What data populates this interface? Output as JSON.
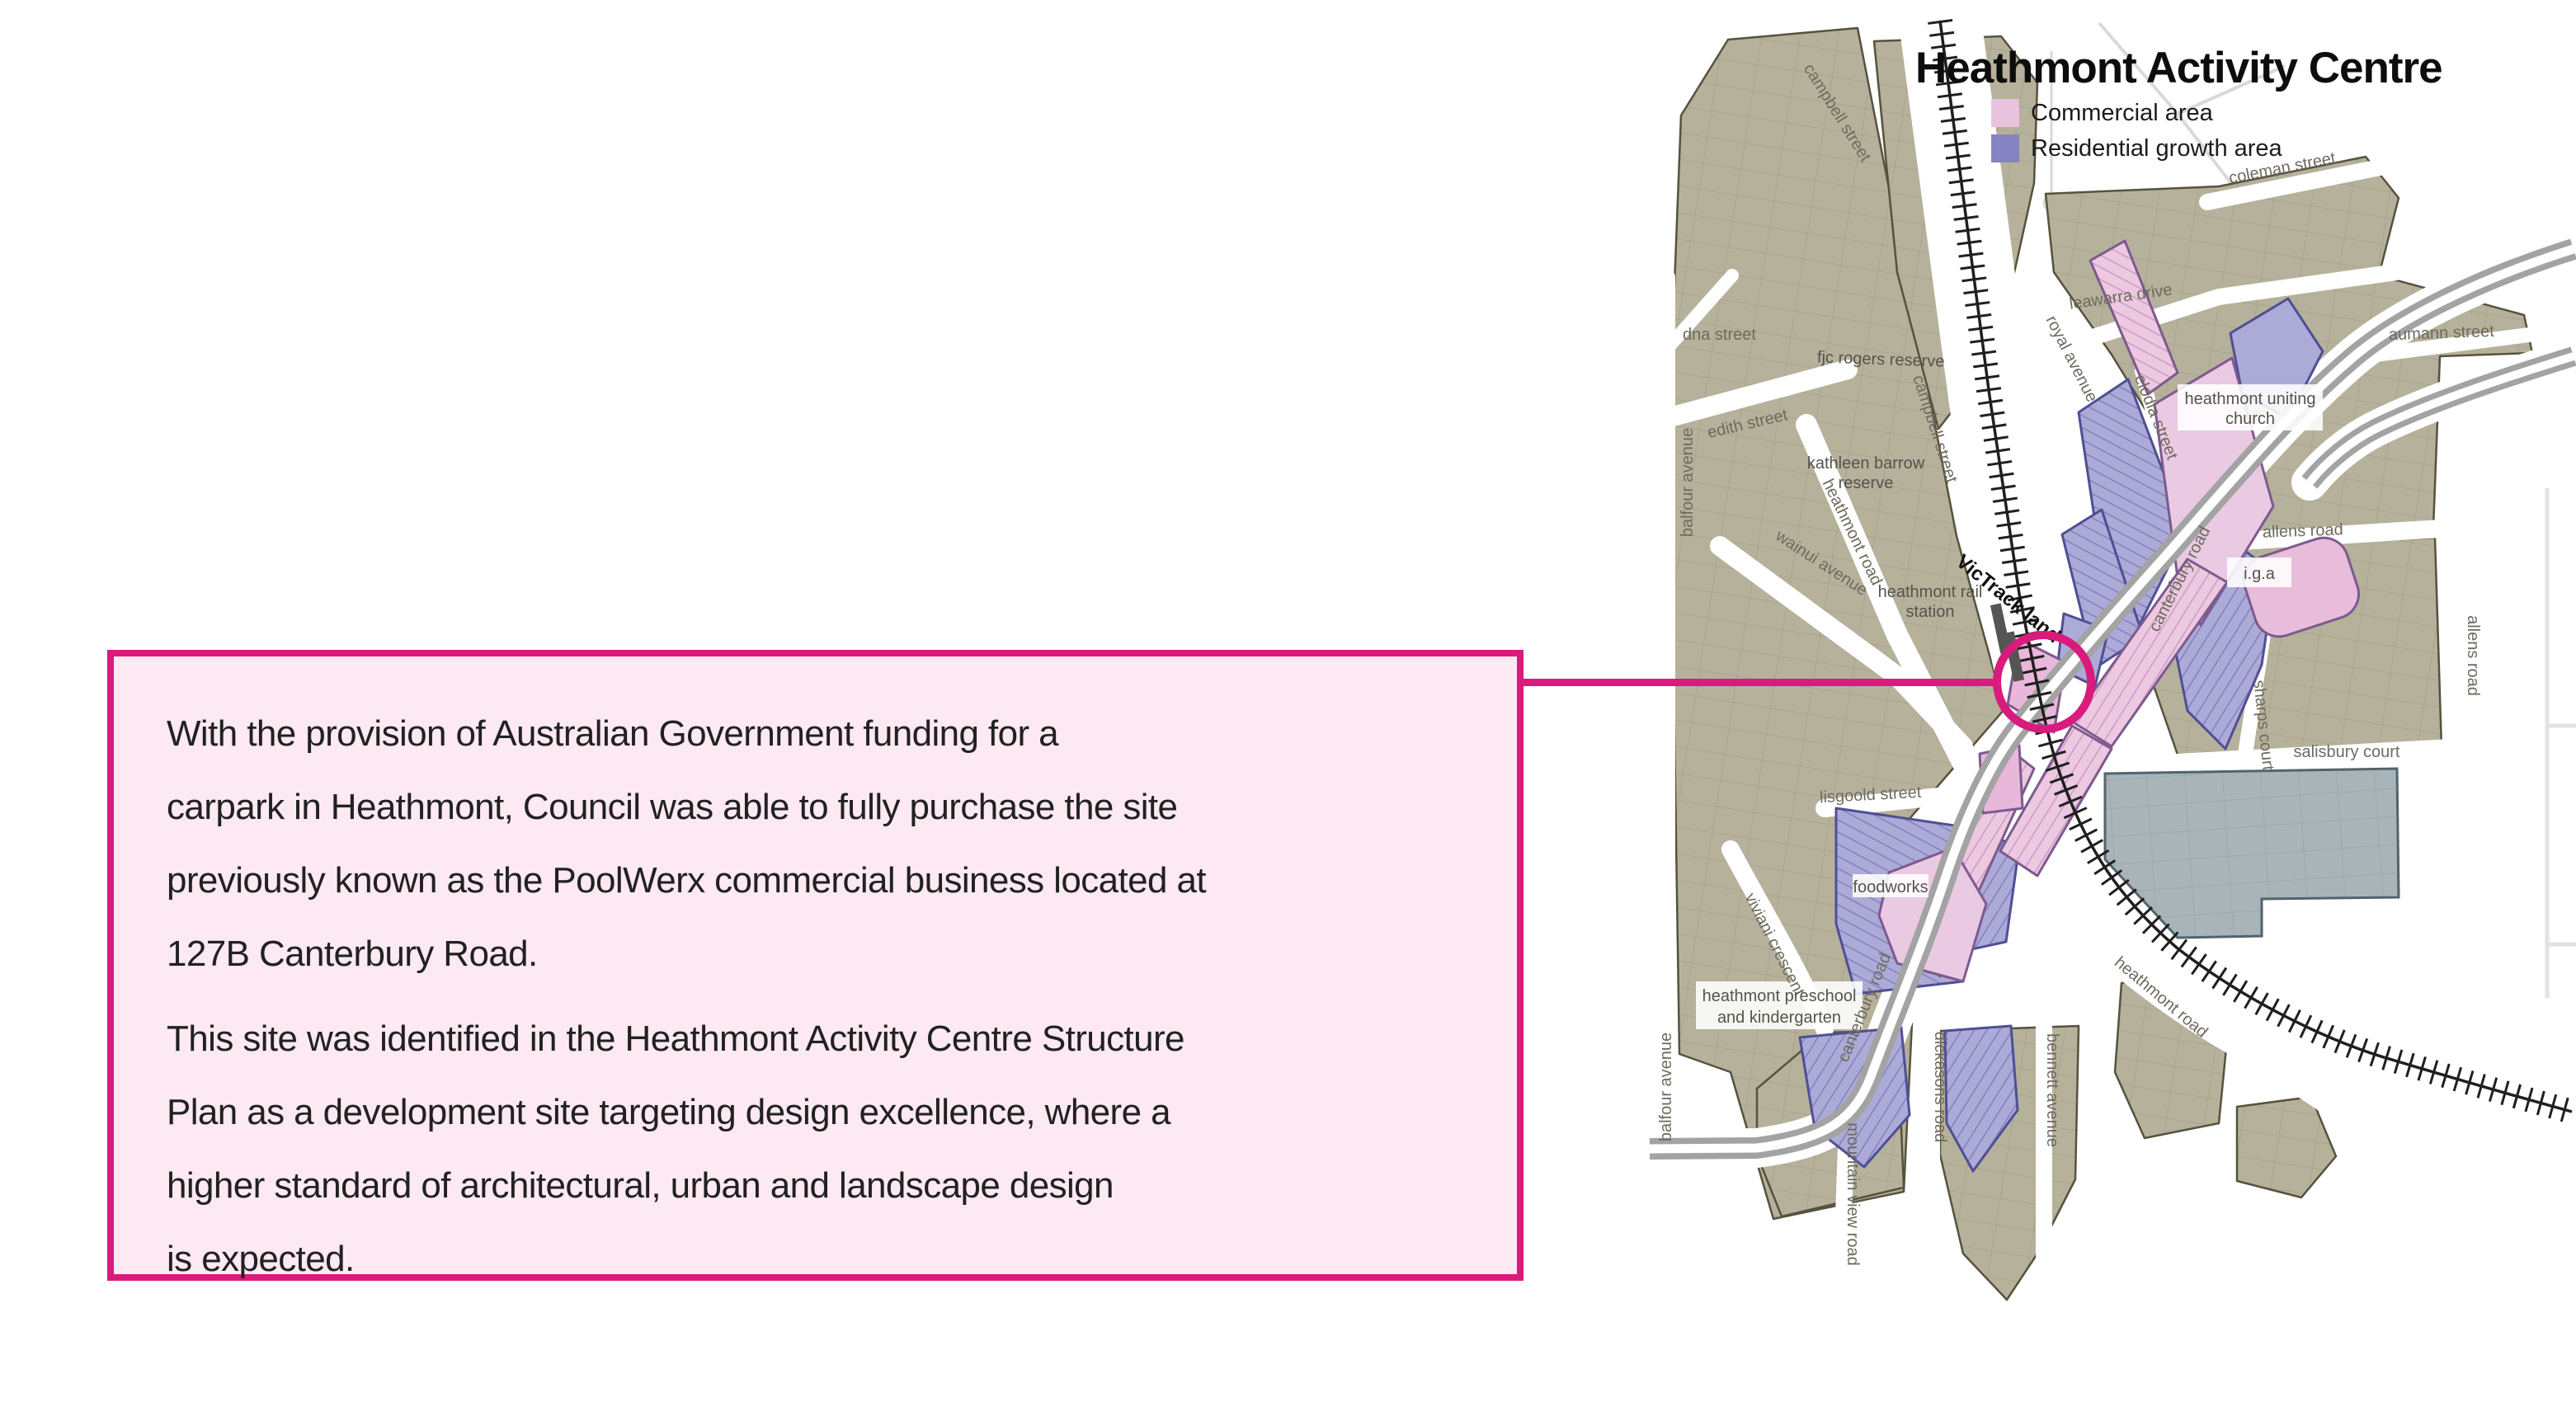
{
  "accent": "#d81b7c",
  "callout": {
    "paragraph1": "With the provision of Australian Government funding for a\ncarpark in Heathmont, Council was able to fully purchase the site\npreviously known as the PoolWerx commercial business located at\n127B Canterbury Road.",
    "paragraph2": "This site was identified in the Heathmont Activity Centre Structure\nPlan as a development site targeting design excellence, where a\nhigher standard of architectural, urban and landscape design\nis expected."
  },
  "map": {
    "title": "Heathmont Activity Centre",
    "legend": {
      "commercial_label": "Commercial area",
      "commercial_color": "#e9c3de",
      "residential_label": "Residential growth area",
      "residential_color": "#8583c1"
    },
    "streets": {
      "dna": "dna street",
      "balfour": "balfour avenue",
      "edith": "edith street",
      "wainui": "wainui avenue",
      "heathmont_road": "heathmont road",
      "campbell": "campbell street",
      "coleman": "coleman street",
      "leawarra": "leawarra drive",
      "royal": "royal avenue",
      "elodia": "elodia street",
      "aumann": "aumann street",
      "allens": "allens road",
      "sharps": "sharps court",
      "salisbury": "salisbury court",
      "canterbury": "canterbury road",
      "lisgoold": "lisgoold street",
      "viviani": "viviani crescent",
      "dickasons": "dickasons road",
      "bennett": "bennett avenue",
      "mountain_view": "mountain view road"
    },
    "landmarks": {
      "fjc_reserve": "fjc rogers reserve",
      "kathleen_line1": "kathleen barrow",
      "kathleen_line2": "reserve",
      "station_line1": "heathmont rail",
      "station_line2": "station",
      "victrack": "VicTrack land",
      "church_line1": "heathmont uniting",
      "church_line2": "church",
      "iga": "i.g.a",
      "foodworks": "foodworks",
      "preschool_line1": "heathmont preschool",
      "preschool_line2": "and kindergarten"
    }
  }
}
